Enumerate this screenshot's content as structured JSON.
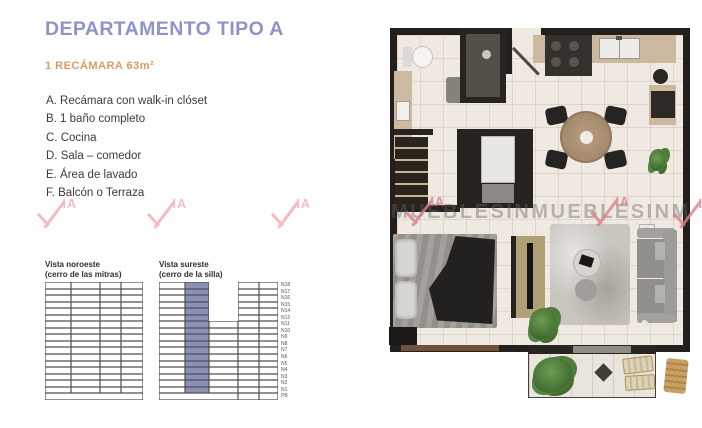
{
  "header": {
    "title": "DEPARTAMENTO TIPO A",
    "subtitle": "1 RECÁMARA 63m²"
  },
  "features": [
    "A. Recámara con walk-in clóset",
    "B. 1 baño completo",
    "C. Cocina",
    "D. Sala – comedor",
    "E. Área de lavado",
    "F. Balcón o Terraza"
  ],
  "watermark": {
    "logo_ia": "IA",
    "strip_text": "MUEBLESINMUEBLESINMUEBLESIN"
  },
  "colors": {
    "title": "#8e93c8",
    "subtitle": "#dc9a60",
    "highlight": "#8d91b8",
    "watermark_pink": "#f3bcc0",
    "watermark_red": "#d98089"
  },
  "availability": {
    "floors": [
      "N18",
      "N17",
      "N16",
      "N15",
      "N14",
      "N12",
      "N11",
      "N10",
      "N9",
      "N8",
      "N7",
      "N6",
      "N5",
      "N4",
      "N3",
      "N2",
      "N1",
      "PB"
    ],
    "tables": [
      {
        "title_line1": "Vista noroeste",
        "title_line2": "(cerro de las mitras)"
      },
      {
        "title_line1": "Vista sureste",
        "title_line2": "(cerro de la silla)"
      }
    ]
  }
}
